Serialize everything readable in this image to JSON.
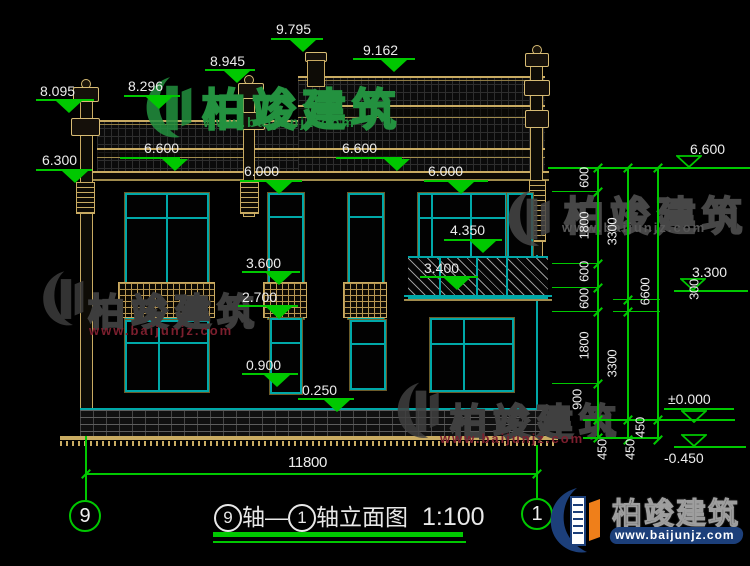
{
  "title_block": {
    "axis_a": "9",
    "seg_a": "轴—",
    "axis_b": "1",
    "seg_b": "轴立面图",
    "scale": "1:100"
  },
  "brand": {
    "name": "柏竣建筑",
    "url": "www.baijunjz.com"
  },
  "bottom_dimension": {
    "label": "11800"
  },
  "axis_bubbles": [
    {
      "label": "9",
      "cx": 85,
      "cy": 514,
      "line_top": 436,
      "line_bottom": 500
    },
    {
      "label": "1",
      "cx": 537,
      "cy": 512,
      "line_top": 445,
      "line_bottom": 498
    }
  ],
  "colors": {
    "dimension_green": "#00c800",
    "building_teal": "#00a8a8",
    "trim_tan": "#c9ab62",
    "text_white": "#ececec",
    "logo_navy": "#1c3f7a",
    "logo_orange": "#ef7f1a",
    "watermark_green": "#23913f",
    "watermark_gray": "#454545",
    "watermark_red": "#7c1f2e"
  },
  "elevation_marks": [
    {
      "v": "8.095",
      "lx": 40,
      "ly": 83,
      "x": 36,
      "y": 99,
      "w": 58,
      "tx": 56,
      "ty": 101,
      "style": "filled"
    },
    {
      "v": "8.296",
      "lx": 128,
      "ly": 78,
      "x": 124,
      "y": 95,
      "w": 56,
      "tx": 146,
      "ty": 97,
      "style": "filled"
    },
    {
      "v": "8.945",
      "lx": 210,
      "ly": 53,
      "x": 205,
      "y": 69,
      "w": 50,
      "tx": 224,
      "ty": 71,
      "style": "filled"
    },
    {
      "v": "9.795",
      "lx": 276,
      "ly": 21,
      "x": 271,
      "y": 38,
      "w": 52,
      "tx": 290,
      "ty": 40,
      "style": "filled"
    },
    {
      "v": "9.162",
      "lx": 363,
      "ly": 42,
      "x": 353,
      "y": 58,
      "w": 62,
      "tx": 381,
      "ty": 60,
      "style": "filled"
    },
    {
      "v": "6.300",
      "lx": 42,
      "ly": 152,
      "x": 36,
      "y": 169,
      "w": 56,
      "tx": 62,
      "ty": 171,
      "style": "filled"
    },
    {
      "v": "6.600",
      "lx": 144,
      "ly": 140,
      "x": 120,
      "y": 157,
      "w": 60,
      "tx": 162,
      "ty": 159,
      "style": "filled"
    },
    {
      "v": "6.600",
      "lx": 342,
      "ly": 140,
      "x": 336,
      "y": 157,
      "w": 66,
      "tx": 384,
      "ty": 159,
      "style": "filled"
    },
    {
      "v": "6.000",
      "lx": 244,
      "ly": 163,
      "x": 240,
      "y": 180,
      "w": 62,
      "tx": 266,
      "ty": 182,
      "style": "filled"
    },
    {
      "v": "6.000",
      "lx": 428,
      "ly": 163,
      "x": 424,
      "y": 180,
      "w": 64,
      "tx": 448,
      "ty": 182,
      "style": "filled"
    },
    {
      "v": "4.350",
      "lx": 450,
      "ly": 222,
      "x": 444,
      "y": 239,
      "w": 58,
      "tx": 470,
      "ty": 241,
      "style": "filled"
    },
    {
      "v": "3.600",
      "lx": 246,
      "ly": 255,
      "x": 242,
      "y": 271,
      "w": 58,
      "tx": 266,
      "ty": 273,
      "style": "filled"
    },
    {
      "v": "2.700",
      "lx": 242,
      "ly": 289,
      "x": 238,
      "y": 305,
      "w": 60,
      "tx": 266,
      "ty": 307,
      "style": "filled"
    },
    {
      "v": "3.400",
      "lx": 424,
      "ly": 260,
      "x": 420,
      "y": 276,
      "w": 58,
      "tx": 444,
      "ty": 278,
      "style": "filled"
    },
    {
      "v": "0.900",
      "lx": 246,
      "ly": 357,
      "x": 242,
      "y": 373,
      "w": 56,
      "tx": 264,
      "ty": 375,
      "style": "filled"
    },
    {
      "v": "0.250",
      "lx": 302,
      "ly": 382,
      "x": 298,
      "y": 398,
      "w": 56,
      "tx": 324,
      "ty": 400,
      "style": "filled"
    },
    {
      "v": "6.600",
      "lx": 690,
      "ly": 141,
      "x": 664,
      "y": 167,
      "w": 86,
      "tx": 676,
      "ty": 155,
      "style": "hollow"
    },
    {
      "v": "3.300",
      "lx": 692,
      "ly": 264,
      "x": 674,
      "y": 290,
      "w": 74,
      "tx": 680,
      "ty": 278,
      "style": "hollow"
    },
    {
      "v": "±0.000",
      "lx": 668,
      "ly": 391,
      "x": 664,
      "y": 408,
      "w": 70,
      "tx": 681,
      "ty": 410,
      "style": "hollow"
    },
    {
      "v": "-0.450",
      "lx": 664,
      "ly": 450,
      "x": 674,
      "y": 446,
      "w": 72,
      "tx": 681,
      "ty": 434,
      "style": "hollow"
    }
  ],
  "right_dimensions": {
    "chains": [
      {
        "x": 597,
        "ticks": [
          168,
          192,
          264,
          288,
          312,
          384,
          420,
          438
        ],
        "labels": [
          {
            "t": "600",
            "x": 584,
            "y": 178
          },
          {
            "t": "1800",
            "x": 584,
            "y": 226
          },
          {
            "t": "600",
            "x": 584,
            "y": 272
          },
          {
            "t": "600",
            "x": 584,
            "y": 299
          },
          {
            "t": "1800",
            "x": 584,
            "y": 346
          },
          {
            "t": "900",
            "x": 577,
            "y": 400
          },
          {
            "t": "450",
            "x": 602,
            "y": 450
          }
        ]
      },
      {
        "x": 627,
        "ticks": [
          168,
          300,
          312,
          420,
          440
        ],
        "labels": [
          {
            "t": "3300",
            "x": 612,
            "y": 232
          },
          {
            "t": "300",
            "x": 694,
            "y": 290
          },
          {
            "t": "3300",
            "x": 612,
            "y": 364
          },
          {
            "t": "450",
            "x": 640,
            "y": 428
          }
        ]
      },
      {
        "x": 657,
        "ticks": [
          168,
          420,
          440
        ],
        "labels": [
          {
            "t": "6600",
            "x": 645,
            "y": 292
          },
          {
            "t": "450",
            "x": 630,
            "y": 450
          }
        ]
      }
    ],
    "connectors": [
      {
        "x": 548,
        "y": 167,
        "w": 202,
        "h": 2
      },
      {
        "x": 552,
        "y": 191,
        "w": 46,
        "h": 1
      },
      {
        "x": 552,
        "y": 263,
        "w": 46,
        "h": 1
      },
      {
        "x": 552,
        "y": 287,
        "w": 46,
        "h": 1
      },
      {
        "x": 552,
        "y": 311,
        "w": 46,
        "h": 1
      },
      {
        "x": 552,
        "y": 383,
        "w": 46,
        "h": 1
      },
      {
        "x": 613,
        "y": 299,
        "w": 47,
        "h": 1
      },
      {
        "x": 613,
        "y": 311,
        "w": 47,
        "h": 1
      },
      {
        "x": 583,
        "y": 419,
        "w": 152,
        "h": 2
      },
      {
        "x": 583,
        "y": 437,
        "w": 78,
        "h": 2
      }
    ]
  },
  "watermarks": [
    {
      "logo_x": 143,
      "logo_y": 73,
      "logo_w": 58,
      "logo_h": 70,
      "color": "#23913f",
      "text": "柏竣建筑",
      "text_x": 202,
      "text_y": 74,
      "text_size": 44,
      "url": "www.baijunjz.com",
      "url_x": 203,
      "url_y": 114,
      "url_size": 14,
      "url_color": "#23913f"
    },
    {
      "logo_x": 40,
      "logo_y": 264,
      "logo_w": 52,
      "logo_h": 70,
      "color": "#3d3d3d",
      "text": "柏竣建筑",
      "text_x": 88,
      "text_y": 282,
      "text_size": 37,
      "url": "www.baijunjz.com",
      "url_x": 89,
      "url_y": 323,
      "url_size": 13,
      "url_color": "#7c1f2e"
    },
    {
      "logo_x": 503,
      "logo_y": 188,
      "logo_w": 58,
      "logo_h": 62,
      "color": "#474747",
      "text": "柏竣建筑",
      "text_x": 564,
      "text_y": 184,
      "text_size": 40,
      "url": "www.baijunjz.com",
      "url_x": 562,
      "url_y": 220,
      "url_size": 13,
      "url_color": "#585858"
    },
    {
      "logo_x": 394,
      "logo_y": 380,
      "logo_w": 54,
      "logo_h": 62,
      "color": "#404040",
      "text": "柏竣建筑",
      "text_x": 450,
      "text_y": 392,
      "text_size": 37,
      "url": "www.baijunjz.com",
      "url_x": 440,
      "url_y": 431,
      "url_size": 13,
      "url_color": "#7c1f2e"
    }
  ]
}
